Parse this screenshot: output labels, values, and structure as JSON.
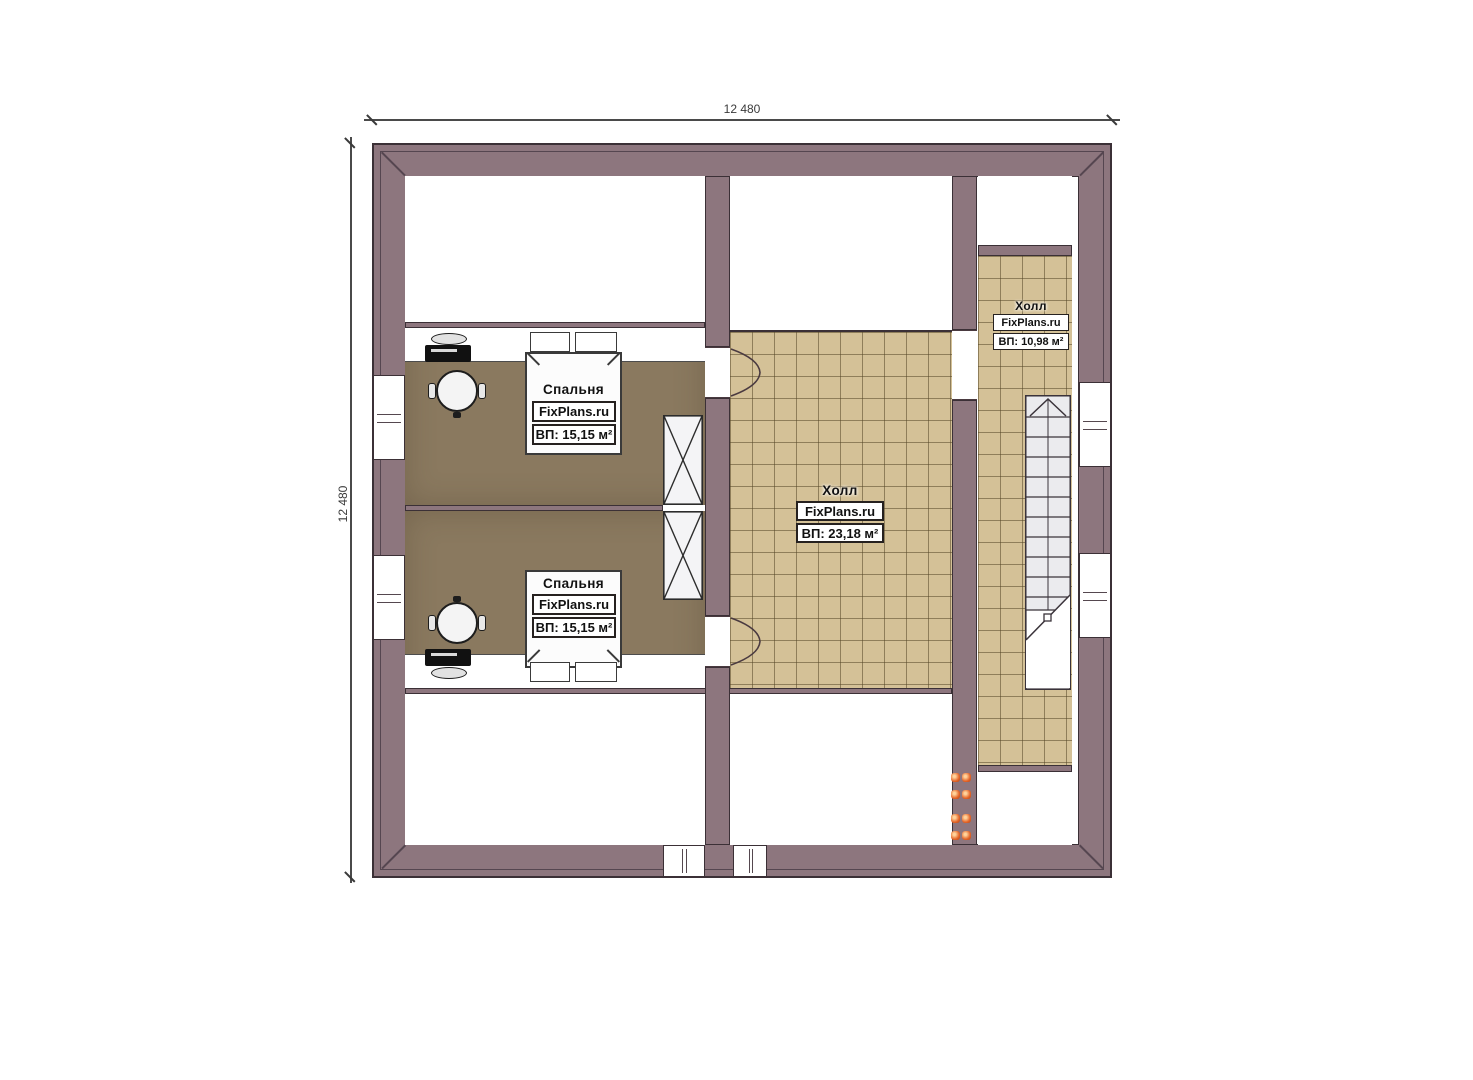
{
  "dimensions": {
    "top": "12 480",
    "left": "12 480"
  },
  "rooms": {
    "bedroom1": {
      "name": "Спальня",
      "brand": "FixPlans.ru",
      "area": "ВП: 15,15 м²"
    },
    "bedroom2": {
      "name": "Спальня",
      "brand": "FixPlans.ru",
      "area": "ВП: 15,15 м²"
    },
    "hall": {
      "name": "Холл",
      "brand": "FixPlans.ru",
      "area": "ВП: 23,18 м²"
    },
    "hall_upper": {
      "name": "Холл",
      "brand": "FixPlans.ru",
      "area": "ВП: 10,98 м²"
    }
  },
  "colors": {
    "wall": "#8d767e",
    "wall_outline": "#3b3036",
    "floor_bedroom": "#8a795f",
    "floor_tile": "#d4c197",
    "heater_dot": "#e4662a"
  }
}
